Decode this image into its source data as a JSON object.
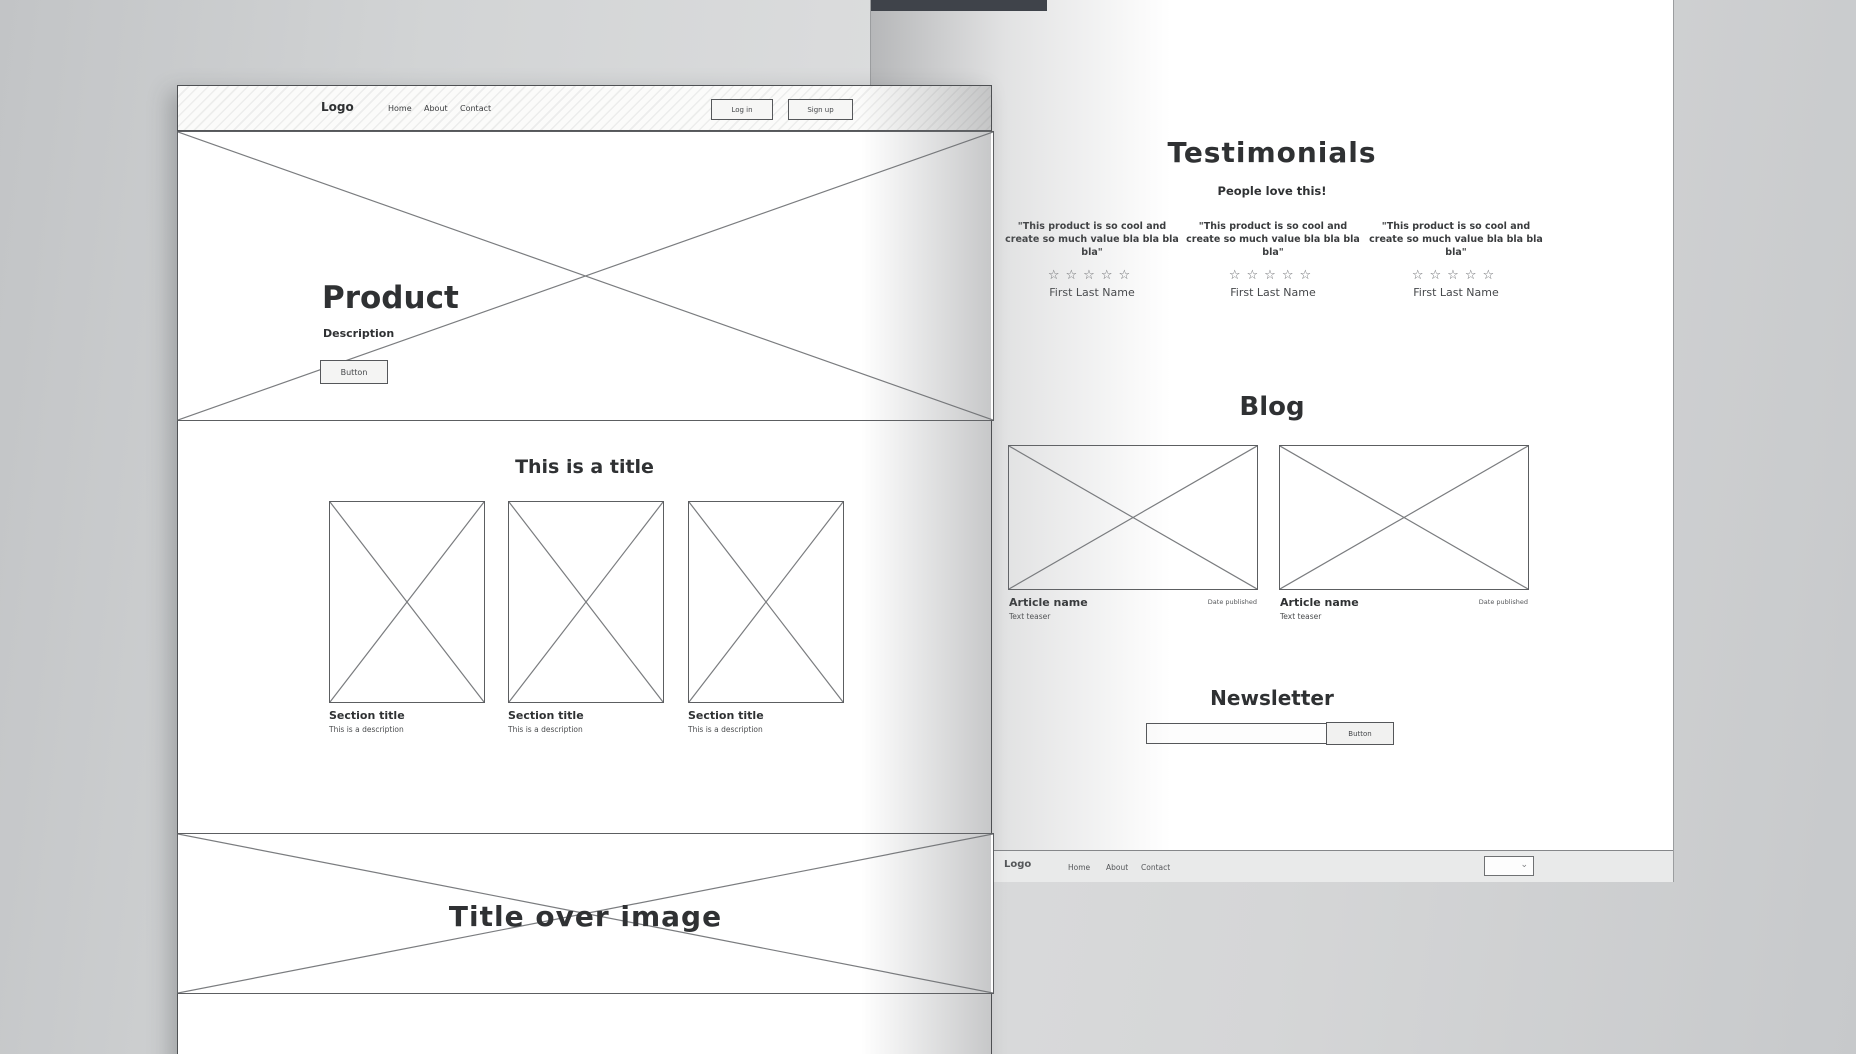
{
  "colors": {
    "backdrop": "#d2d4d5",
    "page_bg": "#ffffff",
    "sketch_line": "#55575a",
    "dark_strip": "#3f434a",
    "footer_band": "#e9eaea"
  },
  "icons": {
    "chevron_down": "⌄"
  },
  "page_left": {
    "header": {
      "logo": "Logo",
      "nav": [
        "Home",
        "About",
        "Contact"
      ],
      "login_button": "Log in",
      "signup_button": "Sign up"
    },
    "hero": {
      "title": "Product",
      "description": "Description",
      "button": "Button"
    },
    "features": {
      "title": "This is a title",
      "items": [
        {
          "title": "Section title",
          "description": "This is a description"
        },
        {
          "title": "Section title",
          "description": "This is a description"
        },
        {
          "title": "Section title",
          "description": "This is a description"
        }
      ]
    },
    "banner": {
      "title": "Title over image"
    }
  },
  "page_right": {
    "testimonials": {
      "title": "Testimonials",
      "subtitle": "People love this!",
      "items": [
        {
          "quote": "\"This product is so cool and create so much value bla bla bla bla\"",
          "stars": "☆☆☆☆☆",
          "name": "First Last Name"
        },
        {
          "quote": "\"This product is so cool and create so much value bla bla bla bla\"",
          "stars": "☆☆☆☆☆",
          "name": "First Last Name"
        },
        {
          "quote": "\"This product is so cool and create so much value bla bla bla bla\"",
          "stars": "☆☆☆☆☆",
          "name": "First Last Name"
        }
      ]
    },
    "blog": {
      "title": "Blog",
      "articles": [
        {
          "name": "Article name",
          "date": "Date published",
          "teaser": "Text teaser"
        },
        {
          "name": "Article name",
          "date": "Date published",
          "teaser": "Text teaser"
        }
      ]
    },
    "newsletter": {
      "title": "Newsletter",
      "input_value": "",
      "button": "Button"
    },
    "footer": {
      "logo": "Logo",
      "nav": [
        "Home",
        "About",
        "Contact"
      ]
    }
  }
}
